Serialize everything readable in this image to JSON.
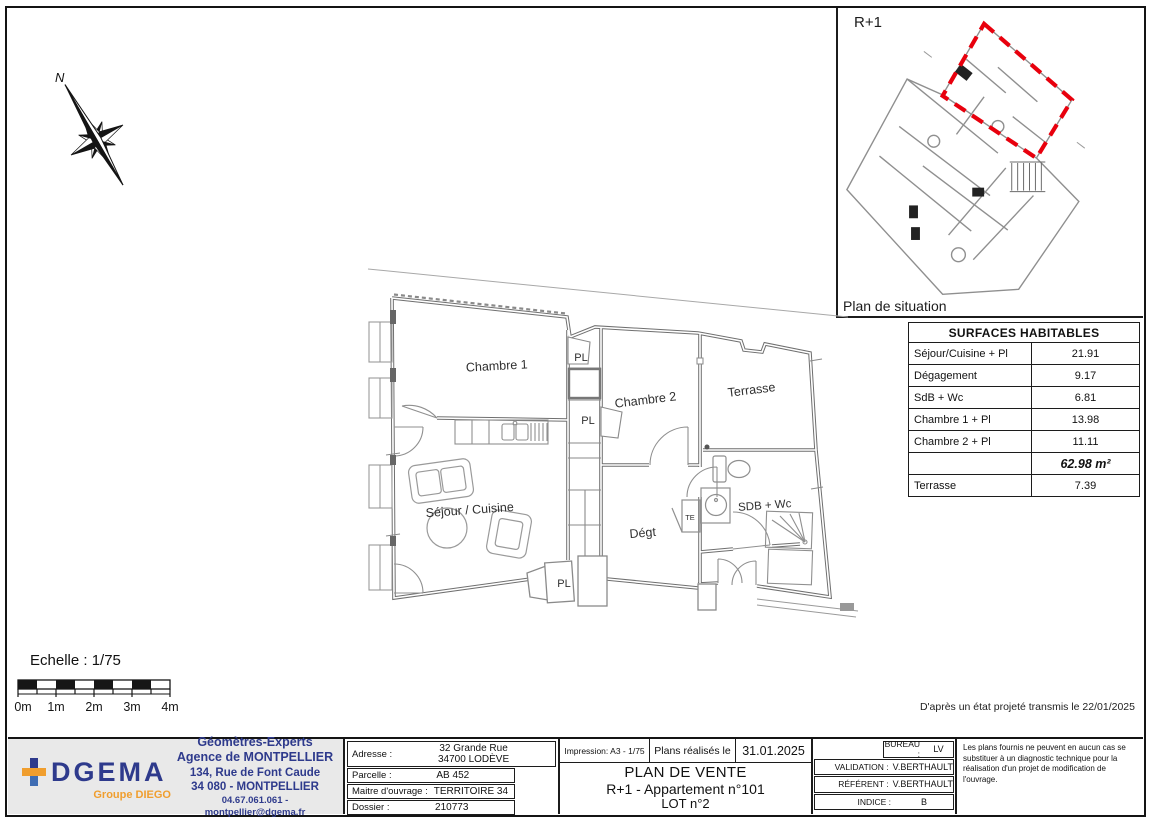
{
  "colors": {
    "accent_red": "#e8000d",
    "navy": "#2e3a8c",
    "orange": "#f09e2e"
  },
  "compass": {
    "north_label": "N"
  },
  "situation": {
    "floor_label": "R+1",
    "caption": "Plan de situation"
  },
  "surfaces": {
    "title": "SURFACES HABITABLES",
    "rows": [
      {
        "label": "Séjour/Cuisine + Pl",
        "value": "21.91"
      },
      {
        "label": "Dégagement",
        "value": "9.17"
      },
      {
        "label": "SdB + Wc",
        "value": "6.81"
      },
      {
        "label": "Chambre 1 + Pl",
        "value": "13.98"
      },
      {
        "label": "Chambre 2 + Pl",
        "value": "11.11"
      },
      {
        "label": "",
        "value": "62.98 m²"
      },
      {
        "label": "Terrasse",
        "value": "7.39"
      }
    ]
  },
  "plan": {
    "rooms": {
      "chambre1": "Chambre 1",
      "chambre2": "Chambre 2",
      "terrasse": "Terrasse",
      "sejour_cuisine": "Séjour / Cuisine",
      "degagement": "Dégt",
      "sdb_wc": "SDB + Wc",
      "pl_top": "PL",
      "pl_mid": "PL",
      "pl_bottom": "PL",
      "te": "TE"
    }
  },
  "scale": {
    "label": "Echelle : 1/75",
    "ticks": [
      "0m",
      "1m",
      "2m",
      "3m",
      "4m"
    ]
  },
  "note": "D'après un état projeté transmis le 22/01/2025",
  "titleblock": {
    "logo": {
      "wordmark": "DGEMA",
      "group": "Groupe DIEGO"
    },
    "agency": {
      "line1": "Géomètres-Experts",
      "line2": "Agence de MONTPELLIER",
      "line3": "134, Rue de Font Caude",
      "line4": "34 080 - MONTPELLIER",
      "line5": "04.67.061.061 - montpellier@dgema.fr"
    },
    "fields": {
      "adresse_label": "Adresse :",
      "adresse_value_line1": "32 Grande Rue",
      "adresse_value_line2": "34700 LODÈVE",
      "parcelle_label": "Parcelle :",
      "parcelle_value": "AB 452",
      "moa_label": "Maitre d'ouvrage :",
      "moa_value": "TERRITOIRE 34",
      "dossier_label": "Dossier :",
      "dossier_value": "210773"
    },
    "print": {
      "impression": "Impression:  A3 - 1/75",
      "realises_label": "Plans réalisés le",
      "date": "31.01.2025"
    },
    "title": {
      "line1": "PLAN DE VENTE",
      "line2": "R+1 - Appartement n°101",
      "line3": "LOT n°2"
    },
    "approvals": {
      "bureau_label": "BUREAU :",
      "bureau_value": "LV",
      "validation_label": "VALIDATION :",
      "validation_value": "V.BERTHAULT",
      "referent_label": "RÉFÉRENT :",
      "referent_value": "V.BERTHAULT",
      "indice_label": "INDICE :",
      "indice_value": "B"
    },
    "disclaimer": "Les plans fournis ne peuvent en aucun cas se substituer à un diagnostic technique pour la réalisation d'un projet de modification de l'ouvrage."
  }
}
